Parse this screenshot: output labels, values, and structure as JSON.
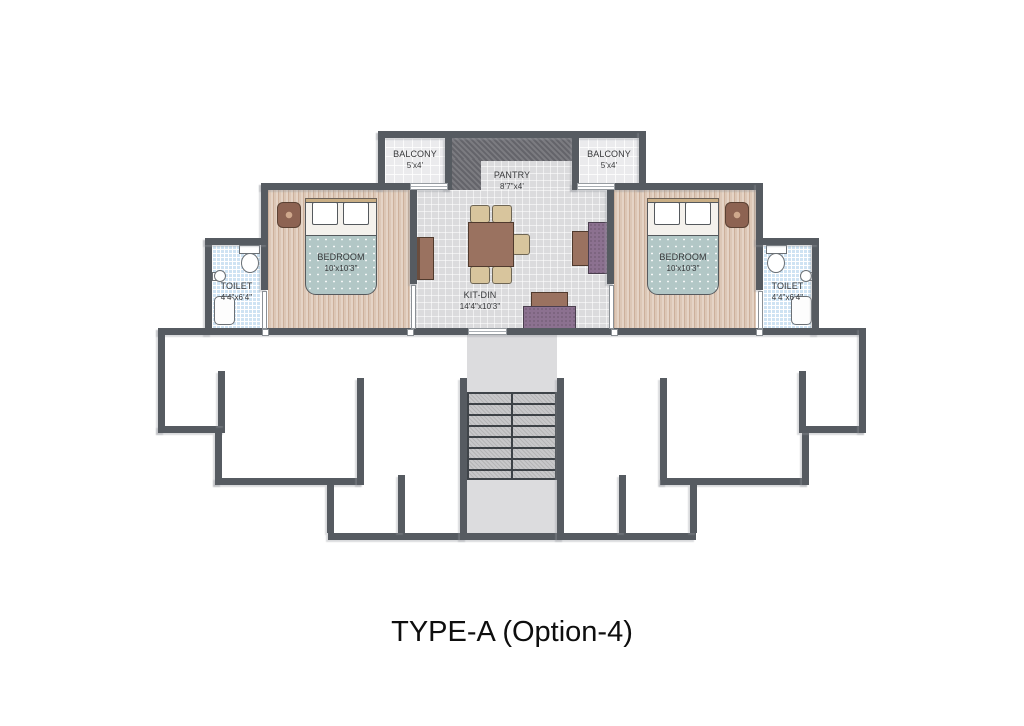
{
  "title": "TYPE-A (Option-4)",
  "rooms": {
    "balcony_left": {
      "name": "BALCONY",
      "dims": "5'x4'"
    },
    "balcony_right": {
      "name": "BALCONY",
      "dims": "5'x4'"
    },
    "pantry": {
      "name": "PANTRY",
      "dims": "8'7\"x4'"
    },
    "bedroom_left": {
      "name": "BEDROOM",
      "dims": "10'x10'3\""
    },
    "bedroom_right": {
      "name": "BEDROOM",
      "dims": "10'x10'3\""
    },
    "toilet_left": {
      "name": "TOILET",
      "dims": "4'4\"x6'4\""
    },
    "toilet_right": {
      "name": "TOILET",
      "dims": "4'4\"x6'4\""
    },
    "kit_din": {
      "name": "KIT-DIN",
      "dims": "14'4\"x10'3\""
    }
  },
  "colors": {
    "wall": "#565b61",
    "wood_floor": "#dcc7b6",
    "tile_floor": "#dbdbdd",
    "toilet_floor": "#cfe3f3",
    "balcony_floor": "#ebebed",
    "pantry_counter": "#6e6e72",
    "bed_blanket": "#b2c7c6",
    "sofa": "#8c7190",
    "table": "#9a7260",
    "chair": "#d8c59d",
    "label_text": "#37383a"
  }
}
